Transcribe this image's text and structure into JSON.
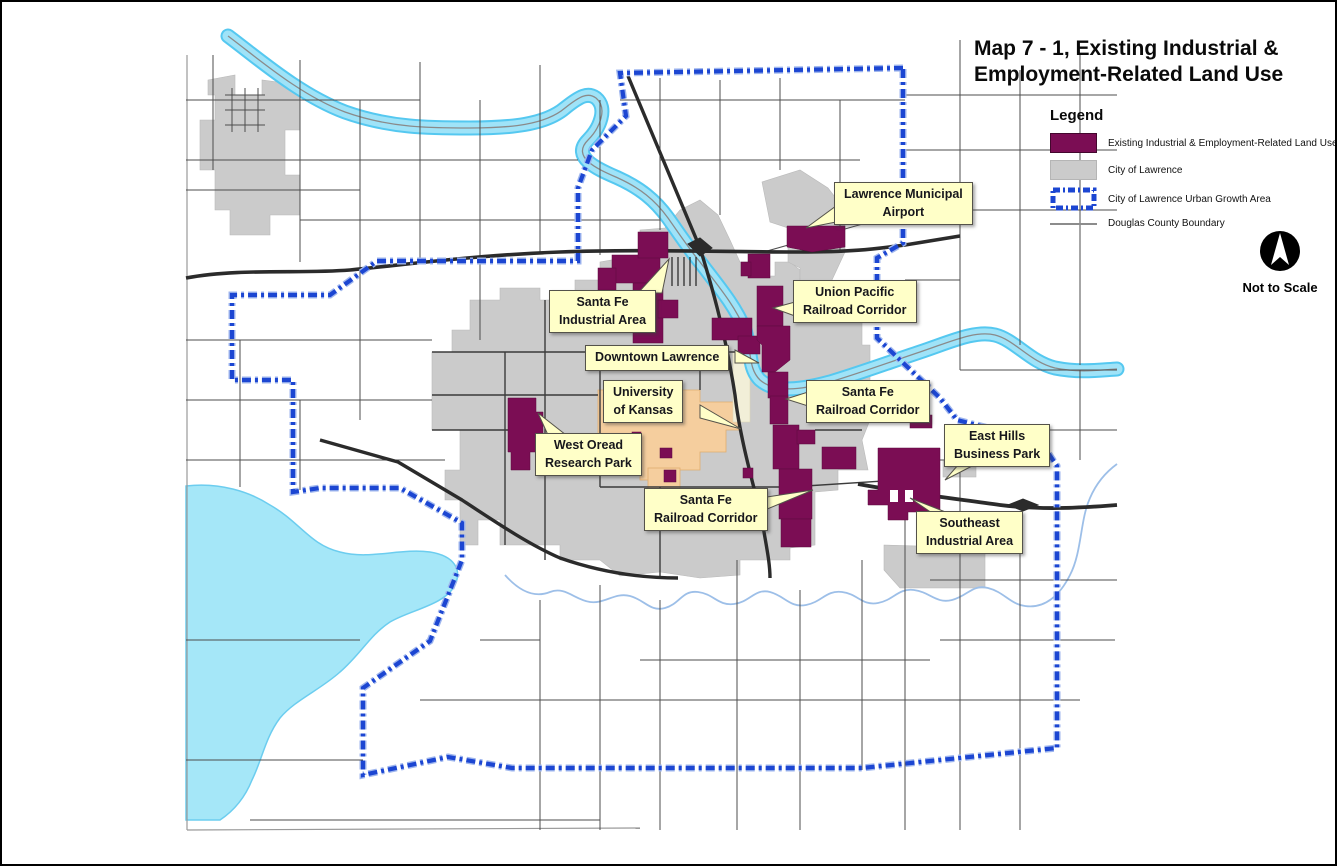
{
  "title": "Map 7 - 1, Existing Industrial &\nEmployment-Related Land Use",
  "legend": {
    "heading": "Legend",
    "items": [
      {
        "label": "Existing Industrial & Employment-Related Land Use",
        "color": "#7B0D54"
      },
      {
        "label": "City of Lawrence",
        "color": "#CBCBCB"
      },
      {
        "label": "City of Lawrence Urban Growth Area",
        "color": "#1C46D2"
      },
      {
        "label": "Douglas County Boundary",
        "color": "#8C8C8C"
      }
    ]
  },
  "north_arrow": {
    "caption": "Not to Scale"
  },
  "callouts": {
    "airport": "Lawrence Municipal\nAirport",
    "santa_fe_industrial": "Santa Fe\nIndustrial Area",
    "union_pacific": "Union Pacific\nRailroad Corridor",
    "downtown": "Downtown Lawrence",
    "university": "University\nof Kansas",
    "santa_fe_corridor_north": "Santa Fe\nRailroad Corridor",
    "west_oread": "West Oread\nResearch Park",
    "santa_fe_corridor_south": "Santa Fe\nRailroad Corridor",
    "east_hills": "East Hills\nBusiness Park",
    "southeast": "Southeast\nIndustrial Area"
  },
  "colors": {
    "industrial": "#7B0D54",
    "city_of_lawrence": "#CBCBCB",
    "urban_growth_area": "#1C46D2",
    "county_boundary": "#8C8C8C",
    "water": "#9FE3F8",
    "university_area": "#F5CE9E",
    "label_fill": "#FFFFC8"
  }
}
